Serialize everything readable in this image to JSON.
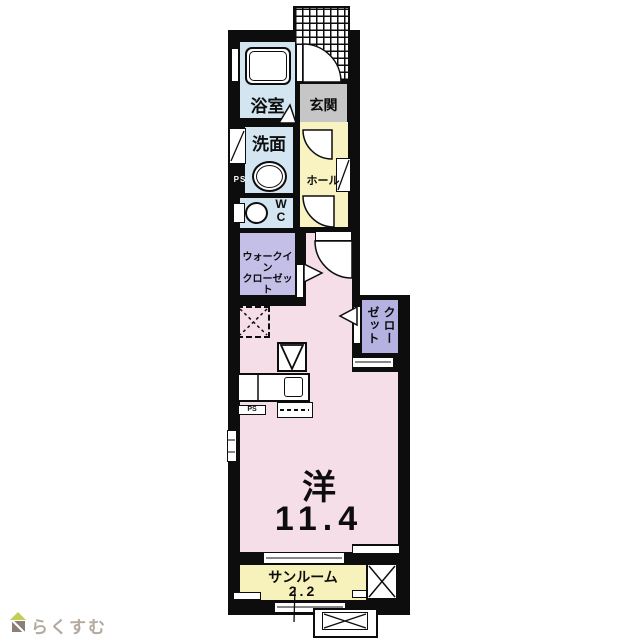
{
  "plan": {
    "labels": {
      "bathroom": "浴室",
      "washroom": "洗面",
      "wc": "W\nC",
      "entrance": "玄関",
      "hall": "ホール",
      "ps_upper": "PS",
      "ps_lower": "PS",
      "walk_in_closet": "ウォークイン\nクローゼット",
      "closet": "クローゼット",
      "main_room_type": "洋",
      "main_room_size": "11.4",
      "sunroom": "サンルーム",
      "sunroom_size": "2.2"
    },
    "colors": {
      "wall": "#0d0d0d",
      "wet": "#d3e5f1",
      "hall": "#f9f3c1",
      "entrance": "#c6c6c6",
      "wic": "#c3bfe7",
      "closet": "#b5b1e0",
      "room": "#f6dee9",
      "sunroom": "#f7f1bb"
    }
  },
  "footer": {
    "logo_text": "らくすむ"
  }
}
